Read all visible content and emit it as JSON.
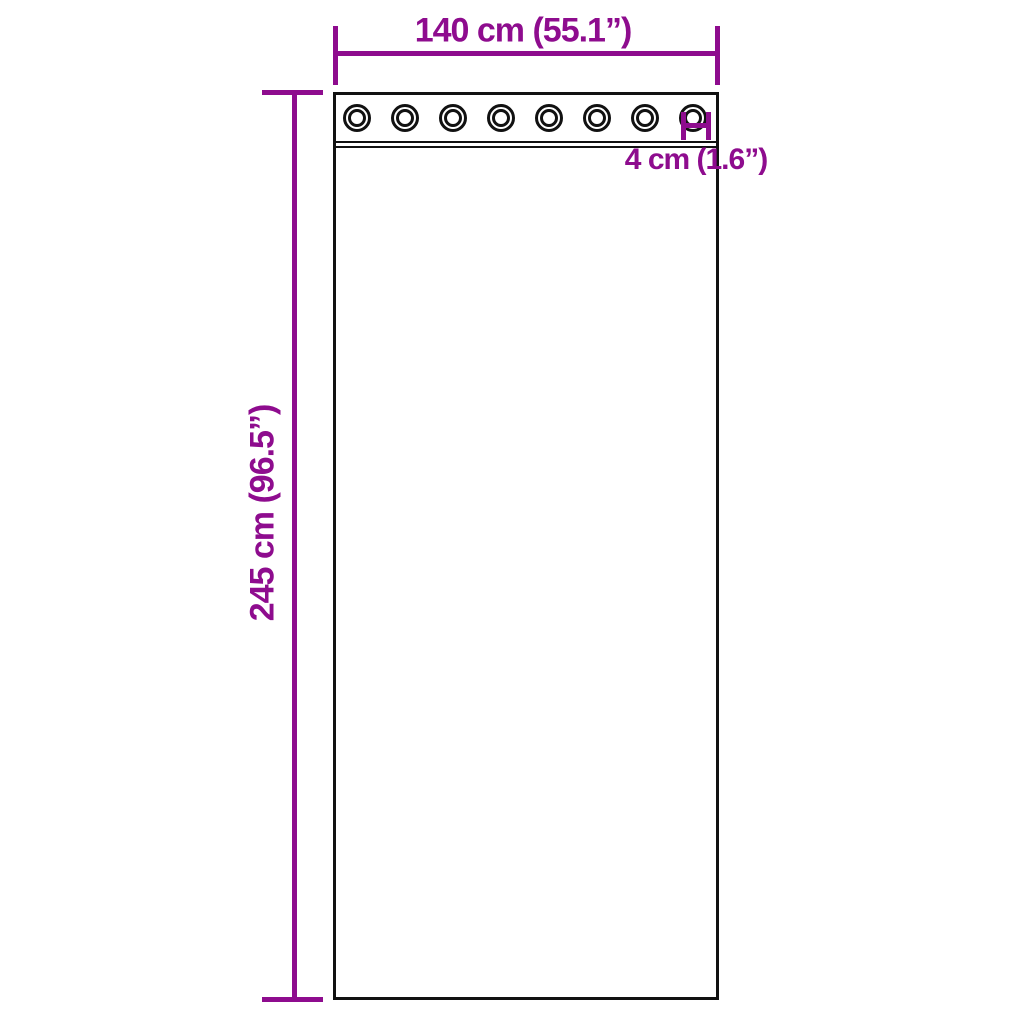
{
  "diagram": {
    "colors": {
      "dimension_accent": "#8E0C8E",
      "outline_ink": "#111111",
      "background": "#ffffff"
    },
    "curtain": {
      "grommet_count": 8
    },
    "labels": {
      "width": "140 cm (55.1”)",
      "height": "245 cm (96.5”)",
      "grommet_diameter": "4 cm (1.6”)"
    }
  }
}
